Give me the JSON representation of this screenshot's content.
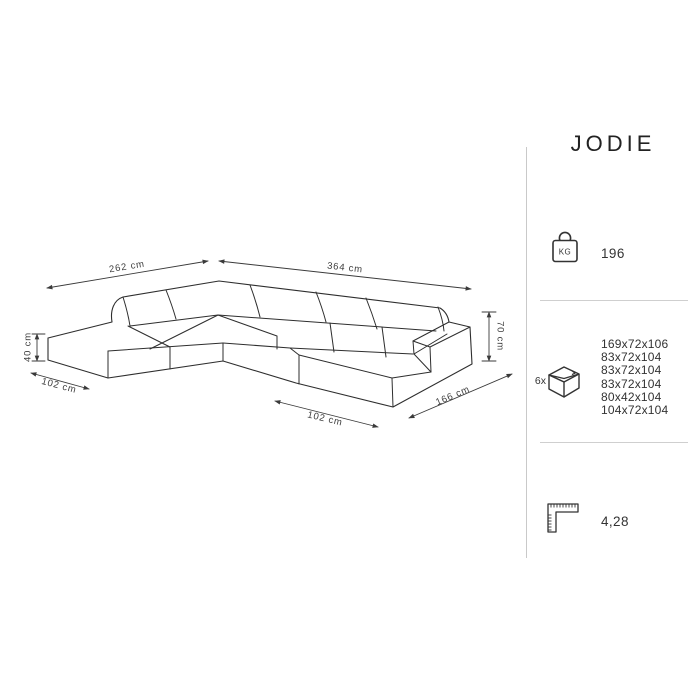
{
  "title": "JODIE",
  "diagram": {
    "labels": {
      "back_left_width": "262 cm",
      "back_right_width": "364 cm",
      "seat_height": "40 cm",
      "left_depth": "102 cm",
      "chaise_front_width": "102 cm",
      "chaise_length": "166 cm",
      "total_height": "70 cm"
    }
  },
  "specs": {
    "weight": {
      "unit_label": "KG",
      "value": "196"
    },
    "packaging": {
      "count": "6x",
      "boxes": [
        "169x72x106",
        "83x72x104",
        "83x72x104",
        "83x72x104",
        "80x42x104",
        "104x72x104"
      ]
    },
    "volume": {
      "value": "4,28"
    }
  }
}
